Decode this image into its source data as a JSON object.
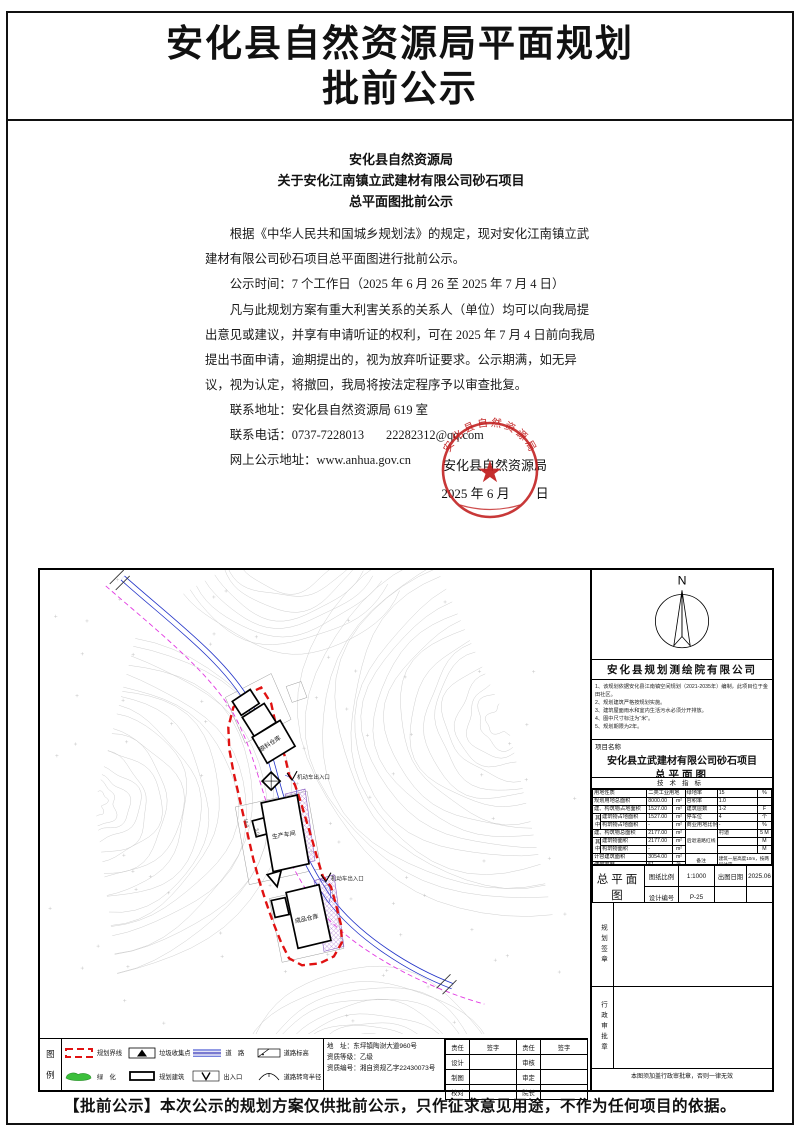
{
  "page": {
    "title": "安化县自然资源局平面规划",
    "title2": "批前公示",
    "footer": "【批前公示】本次公示的规划方案仅供批前公示，只作征求意见用途，不作为任何项目的依据。"
  },
  "notice": {
    "h1": "安化县自然资源局",
    "h2": "关于安化江南镇立武建材有限公司砂石项目",
    "h3": "总平面图批前公示",
    "p1": "根据《中华人民共和国城乡规划法》的规定，现对安化江南镇立武建材有限公司砂石项目总平面图进行批前公示。",
    "p2": "公示时间：7 个工作日（2025 年 6 月 26 至 2025 年 7 月 4 日）",
    "p3": "凡与此规划方案有重大利害关系的关系人（单位）均可以向我局提出意见或建议，并享有申请听证的权利，可在 2025 年 7 月 4 日前向我局提出书面申请，逾期提出的，视为放弃听证要求。公示期满，如无异议，视为认定，将撤回，我局将按法定程序予以审查批复。",
    "addr": "联系地址：安化县自然资源局 619 室",
    "phone": "联系电话：0737-7228013",
    "email": "22282312@qq.com",
    "web": "网上公示地址：www.anhua.gov.cn",
    "sign_org": "安化县自然资源局",
    "sign_date": "2025 年 6 月　　日",
    "seal_ring": "安化县自然资源局",
    "seal_color": "#c22222"
  },
  "plan": {
    "north": "N",
    "company": "安化县规划测绘院有限公司",
    "notes": [
      "1、该规划依据安化县江南镇空间规划（2021-2035年）编制，此项目位于金田社区。",
      "2、规划建筑严格按规划实施。",
      "3、建筑屋面雨水和室内生活污水必须分开排放。",
      "4、图中尺寸标注为“米”。",
      "5、规划期限为2年。"
    ],
    "project_label": "项目名称",
    "project_name": "安化县立武建材有限公司砂石项目",
    "project_sub": "总平面图",
    "tech_header": "技术指标",
    "labels": {
      "raw": "原料仓库",
      "workshop": "生产车间",
      "finished": "成品仓库",
      "gate1": "机动车出入口",
      "gate2": "机动车出入口",
      "dim1": "18.0",
      "dim2": "5.0"
    }
  },
  "tech": {
    "qz": "其中",
    "l1": {
      "l": "用地性质",
      "v": "二类工业用地"
    },
    "l2": {
      "l": "规划用地总面积",
      "v": "8000.00",
      "u": "m²"
    },
    "l3": {
      "l": "建、构筑物占地面积",
      "v": "1527.00",
      "u": "m²"
    },
    "l4": {
      "l": "建筑物占地面积",
      "v": "1527.00",
      "u": "m²"
    },
    "l5": {
      "l": "构筑物占地面积",
      "v": "-",
      "u": "m²"
    },
    "l6": {
      "l": "建、构筑物总面积",
      "v": "2177.00",
      "u": "m²"
    },
    "l7": {
      "l": "建筑物面积",
      "v": "2177.00",
      "u": "m²"
    },
    "l8": {
      "l": "构筑物面积",
      "v": "-",
      "u": "m²"
    },
    "l9": {
      "l": "计容建筑面积",
      "v": "3054.00",
      "u": "m²"
    },
    "l10": {
      "l": "建筑密度",
      "v": "51",
      "u": "%"
    },
    "r1": {
      "l": "绿地率",
      "v": "15",
      "u": "%"
    },
    "r2": {
      "l": "容积率",
      "v": "1.0",
      "u": ""
    },
    "r3": {
      "l": "建筑层数",
      "v": "1-2",
      "u": "F"
    },
    "r4": {
      "l": "停车位",
      "v": "4",
      "u": "个"
    },
    "r5": {
      "l": "商业用地比例",
      "v": "-",
      "u": "%"
    },
    "r6": {
      "l": "后退道路红线",
      "v": "村道",
      "u": "5 M"
    },
    "r7": {
      "v": "",
      "u": "M"
    },
    "r8": {
      "v": "",
      "u": "M"
    },
    "r9": {
      "l": "备注",
      "v": "建筑一层高度10m，按两层计容"
    }
  },
  "titleblock": {
    "sheet": "总平面图",
    "scale_l": "图纸比例",
    "scale": "1:1000",
    "date_l": "出图日期",
    "date": "2025.06",
    "no_l": "设计编号",
    "no": "P-25",
    "sign": "规划签章",
    "approval": "行政审批章",
    "note": "本图须加盖行政审批章，否则一律无效"
  },
  "legend": {
    "t1": "图",
    "t2": "例",
    "items": [
      "规划界线",
      "垃圾收集点",
      "道　路",
      "道路标高",
      "绿　化",
      "规划建筑",
      "出入口",
      "道路转弯半径"
    ]
  },
  "firm": {
    "addr": "地　址：东坪镇陶澍大道960号",
    "grade": "资质等级：乙级",
    "cert": "资质编号：湘自资规乙字22430073号"
  },
  "signs": {
    "h": [
      "责任",
      "签字",
      "责任",
      "签字"
    ],
    "rows": [
      [
        "设计",
        "",
        "审核",
        ""
      ],
      [
        "制图",
        "",
        "审定",
        ""
      ],
      [
        "校对",
        "",
        "院长",
        ""
      ]
    ]
  }
}
